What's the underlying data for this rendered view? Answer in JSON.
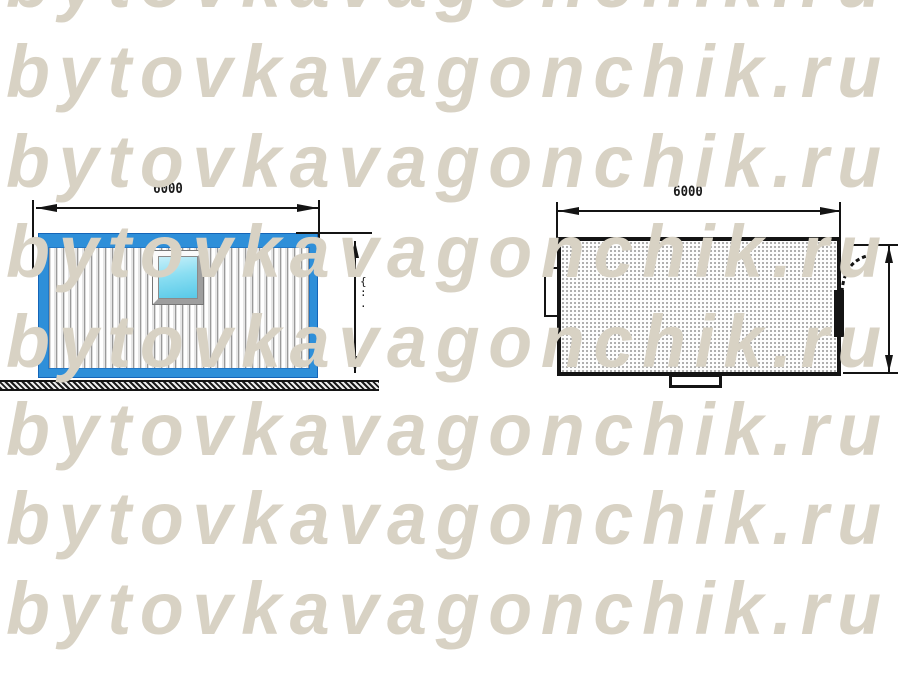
{
  "watermark": {
    "text": "bytovkavagonchik.ru",
    "color": "#d8d2c4",
    "row_count": 8
  },
  "elevation": {
    "length_label": "6000",
    "height_ticks": "{\n:\n.",
    "colors": {
      "frame_blue": "#2e8fd9",
      "glass_cyan": "#8adef2",
      "line_black": "#141414"
    }
  },
  "plan": {
    "length_label": "6000",
    "fill_dot_color": "#a9a9a9"
  }
}
